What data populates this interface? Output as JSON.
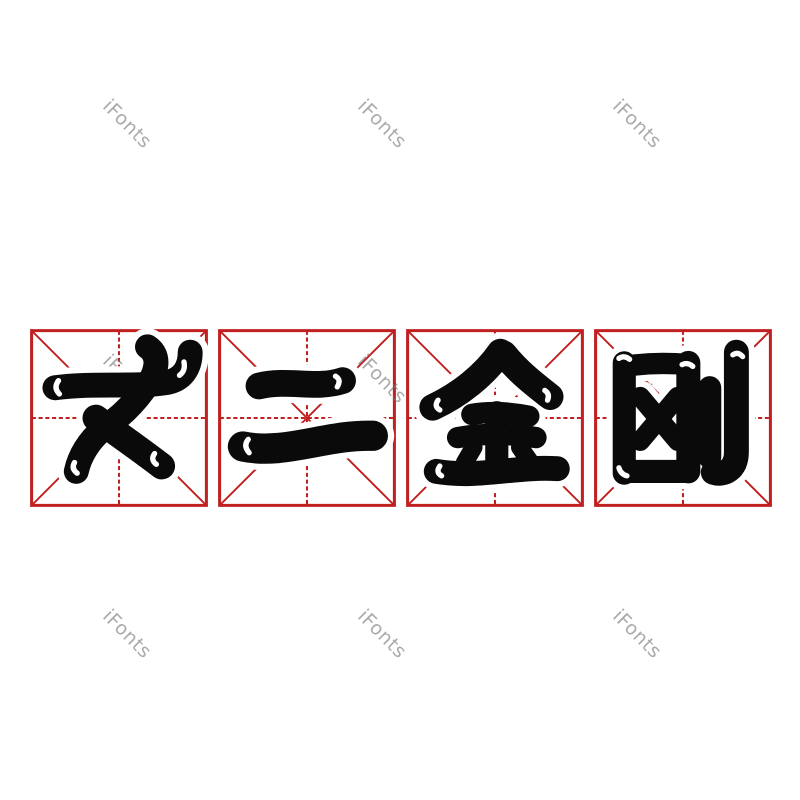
{
  "canvas": {
    "width": 800,
    "height": 800,
    "background": "#ffffff"
  },
  "watermark": {
    "text": "iFonts",
    "color": "rgba(120,120,120,0.62)",
    "rotation_deg": 45,
    "positions": [
      {
        "x": 127,
        "y": 124
      },
      {
        "x": 382,
        "y": 124
      },
      {
        "x": 637,
        "y": 124
      },
      {
        "x": 127,
        "y": 379
      },
      {
        "x": 382,
        "y": 379
      },
      {
        "x": 637,
        "y": 379
      },
      {
        "x": 127,
        "y": 634
      },
      {
        "x": 382,
        "y": 634
      },
      {
        "x": 637,
        "y": 634
      }
    ]
  },
  "phrase": {
    "text": "丈二金刚",
    "characters": [
      {
        "char": "丈"
      },
      {
        "char": "二"
      },
      {
        "char": "金"
      },
      {
        "char": "刚"
      }
    ]
  },
  "practice_grid": {
    "grid_style": "mi-zi-ge",
    "line_color": "#c02020",
    "glyph_color": "#0a0a0a",
    "box_size": 178,
    "box_y": 329,
    "box_x": [
      30,
      218,
      406,
      594
    ]
  }
}
